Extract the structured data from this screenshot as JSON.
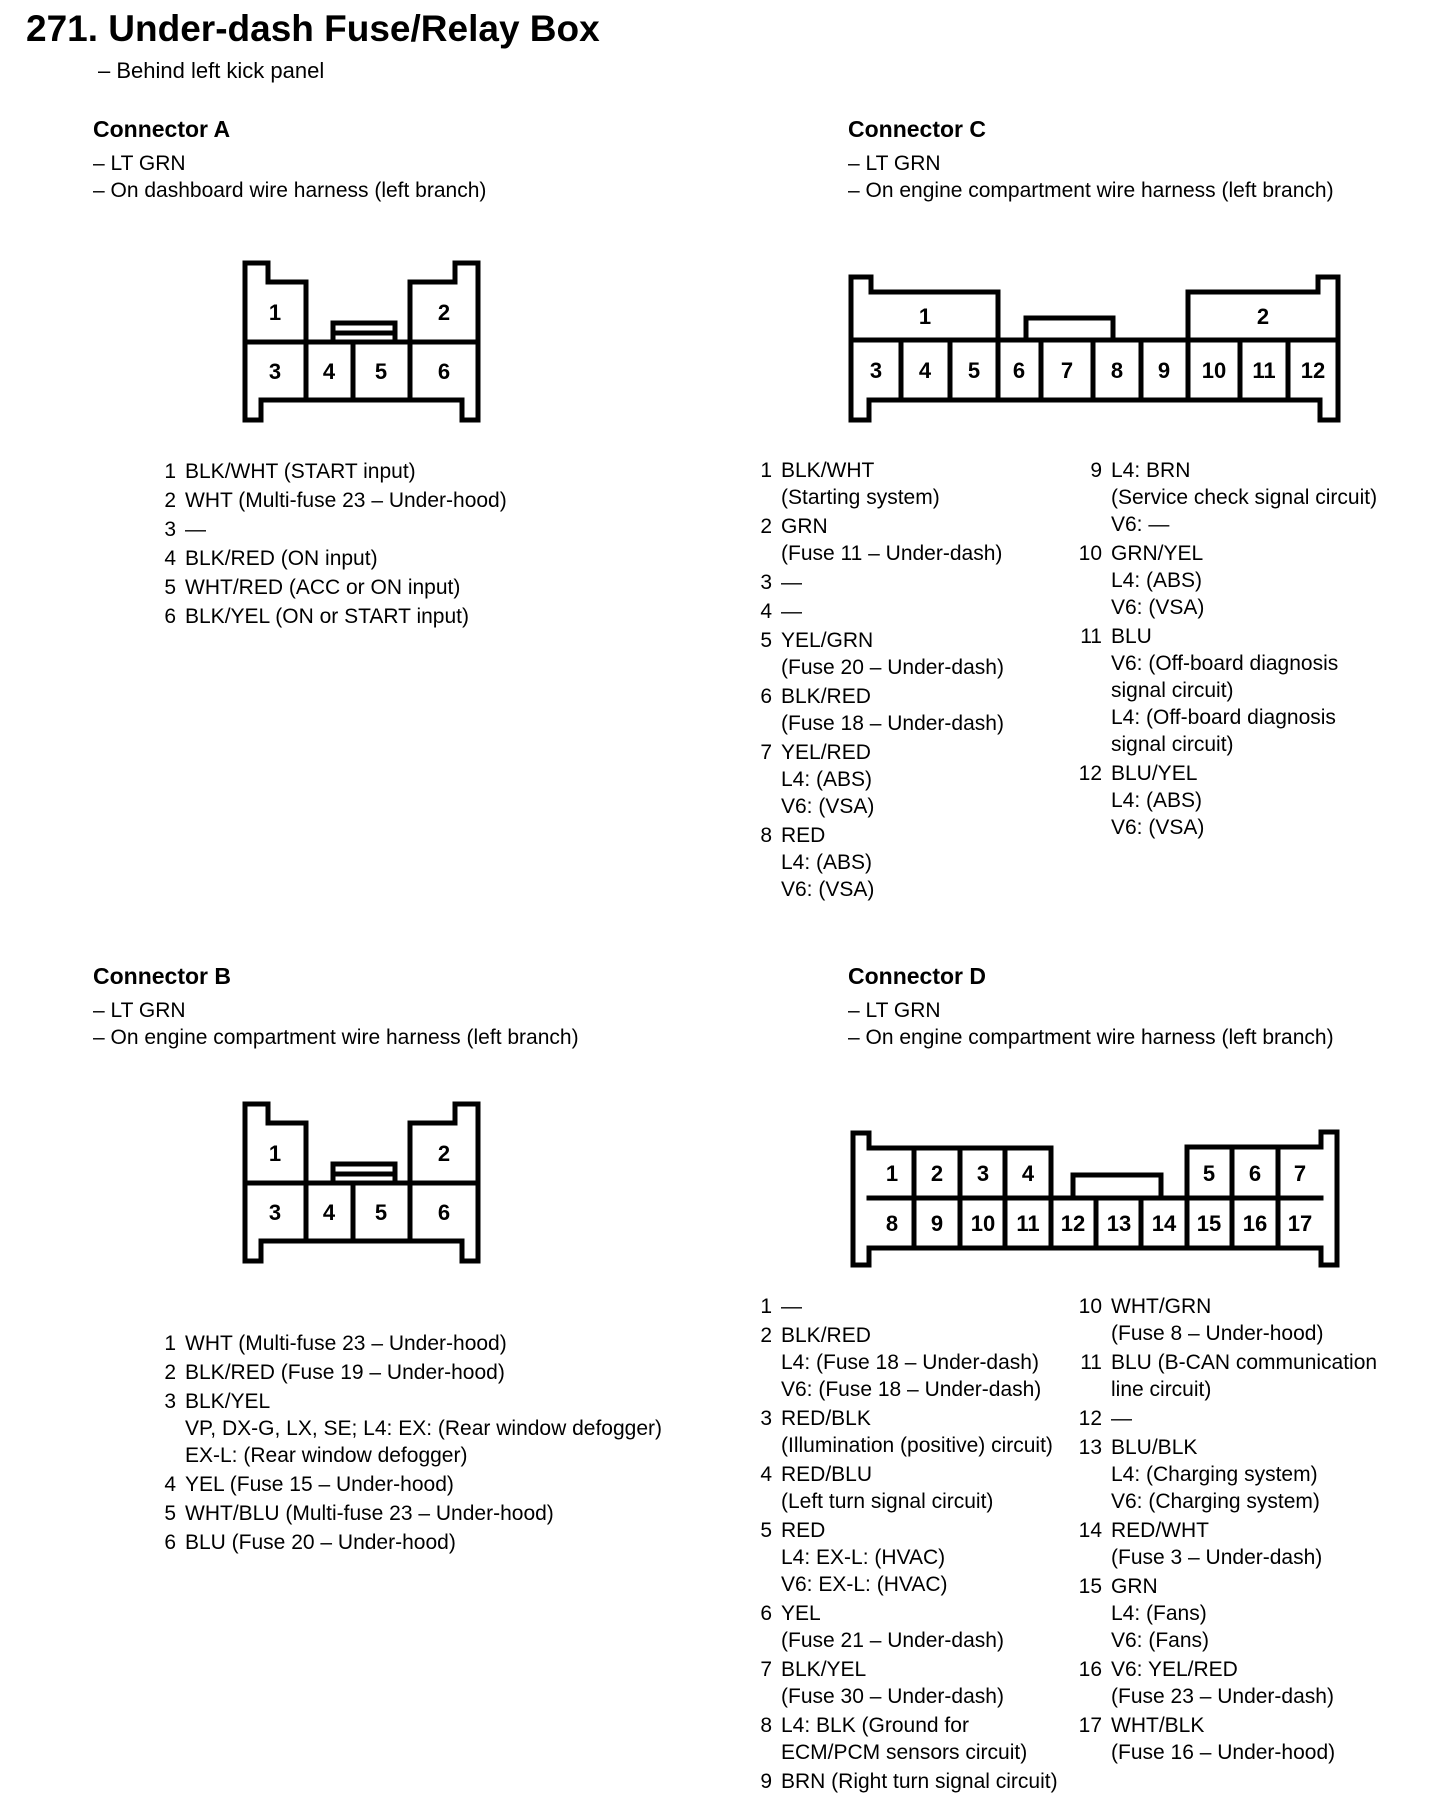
{
  "page": {
    "title": "271. Under-dash Fuse/Relay Box",
    "subnote": "– Behind left kick panel"
  },
  "connectors": [
    {
      "id": "A",
      "heading": "Connector A",
      "notes": [
        "– LT GRN",
        "– On dashboard wire harness (left branch)"
      ],
      "diagram": {
        "top_labels": [
          "1",
          "2"
        ],
        "bottom_labels": [
          "3",
          "4",
          "5",
          "6"
        ]
      },
      "columns": [
        [
          {
            "n": "1",
            "lines": [
              "BLK/WHT (START input)"
            ]
          },
          {
            "n": "2",
            "lines": [
              "WHT (Multi-fuse 23 – Under-hood)"
            ]
          },
          {
            "n": "3",
            "lines": [
              "—"
            ]
          },
          {
            "n": "4",
            "lines": [
              "BLK/RED (ON input)"
            ]
          },
          {
            "n": "5",
            "lines": [
              "WHT/RED (ACC or ON input)"
            ]
          },
          {
            "n": "6",
            "lines": [
              "BLK/YEL (ON or START input)"
            ]
          }
        ]
      ]
    },
    {
      "id": "C",
      "heading": "Connector C",
      "notes": [
        "– LT GRN",
        "– On engine compartment wire harness (left branch)"
      ],
      "diagram": {
        "top_labels": [
          "1",
          "2"
        ],
        "bottom_labels": [
          "3",
          "4",
          "5",
          "6",
          "7",
          "8",
          "9",
          "10",
          "11",
          "12"
        ]
      },
      "columns": [
        [
          {
            "n": "1",
            "lines": [
              "BLK/WHT",
              "(Starting system)"
            ]
          },
          {
            "n": "2",
            "lines": [
              "GRN",
              "(Fuse 11 – Under-dash)"
            ]
          },
          {
            "n": "3",
            "lines": [
              "—"
            ]
          },
          {
            "n": "4",
            "lines": [
              "—"
            ]
          },
          {
            "n": "5",
            "lines": [
              "YEL/GRN",
              "(Fuse 20 – Under-dash)"
            ]
          },
          {
            "n": "6",
            "lines": [
              "BLK/RED",
              "(Fuse 18 – Under-dash)"
            ]
          },
          {
            "n": "7",
            "lines": [
              "YEL/RED",
              "L4: (ABS)",
              "V6: (VSA)"
            ]
          },
          {
            "n": "8",
            "lines": [
              "RED",
              "L4: (ABS)",
              "V6: (VSA)"
            ]
          }
        ],
        [
          {
            "n": "9",
            "lines": [
              "L4: BRN",
              "(Service check signal circuit)",
              "V6: —"
            ]
          },
          {
            "n": "10",
            "lines": [
              "GRN/YEL",
              "L4: (ABS)",
              "V6: (VSA)"
            ]
          },
          {
            "n": "11",
            "lines": [
              "BLU",
              "V6: (Off-board diagnosis",
              "signal circuit)",
              "L4: (Off-board diagnosis",
              "signal circuit)"
            ]
          },
          {
            "n": "12",
            "lines": [
              "BLU/YEL",
              "L4: (ABS)",
              "V6: (VSA)"
            ]
          }
        ]
      ]
    },
    {
      "id": "B",
      "heading": "Connector B",
      "notes": [
        "– LT GRN",
        "– On engine compartment wire harness (left branch)"
      ],
      "diagram": {
        "top_labels": [
          "1",
          "2"
        ],
        "bottom_labels": [
          "3",
          "4",
          "5",
          "6"
        ]
      },
      "columns": [
        [
          {
            "n": "1",
            "lines": [
              "WHT (Multi-fuse 23 – Under-hood)"
            ]
          },
          {
            "n": "2",
            "lines": [
              "BLK/RED (Fuse 19 – Under-hood)"
            ]
          },
          {
            "n": "3",
            "lines": [
              "BLK/YEL",
              "VP, DX-G, LX, SE; L4: EX: (Rear window defogger)",
              "EX-L: (Rear window defogger)"
            ]
          },
          {
            "n": "4",
            "lines": [
              "YEL (Fuse 15 – Under-hood)"
            ]
          },
          {
            "n": "5",
            "lines": [
              "WHT/BLU (Multi-fuse 23 – Under-hood)"
            ]
          },
          {
            "n": "6",
            "lines": [
              "BLU (Fuse 20 – Under-hood)"
            ]
          }
        ]
      ]
    },
    {
      "id": "D",
      "heading": "Connector D",
      "notes": [
        "– LT GRN",
        "– On engine compartment wire harness (left branch)"
      ],
      "diagram": {
        "top_labels": [
          "1",
          "2",
          "3",
          "4",
          "5",
          "6",
          "7"
        ],
        "bottom_labels": [
          "8",
          "9",
          "10",
          "11",
          "12",
          "13",
          "14",
          "15",
          "16",
          "17"
        ]
      },
      "columns": [
        [
          {
            "n": "1",
            "lines": [
              "—"
            ]
          },
          {
            "n": "2",
            "lines": [
              "BLK/RED",
              "L4: (Fuse 18 – Under-dash)",
              "V6: (Fuse 18 – Under-dash)"
            ]
          },
          {
            "n": "3",
            "lines": [
              "RED/BLK",
              "(Illumination (positive) circuit)"
            ]
          },
          {
            "n": "4",
            "lines": [
              "RED/BLU",
              "(Left turn signal circuit)"
            ]
          },
          {
            "n": "5",
            "lines": [
              "RED",
              "L4: EX-L: (HVAC)",
              "V6: EX-L: (HVAC)"
            ]
          },
          {
            "n": "6",
            "lines": [
              "YEL",
              "(Fuse 21 – Under-dash)"
            ]
          },
          {
            "n": "7",
            "lines": [
              "BLK/YEL",
              "(Fuse 30 – Under-dash)"
            ]
          },
          {
            "n": "8",
            "lines": [
              "L4: BLK (Ground for",
              "ECM/PCM sensors circuit)"
            ]
          },
          {
            "n": "9",
            "lines": [
              "BRN (Right turn signal circuit)"
            ]
          }
        ],
        [
          {
            "n": "10",
            "lines": [
              "WHT/GRN",
              "(Fuse 8 – Under-hood)"
            ]
          },
          {
            "n": "11",
            "lines": [
              "BLU (B-CAN communication",
              "line circuit)"
            ]
          },
          {
            "n": "12",
            "lines": [
              "—"
            ]
          },
          {
            "n": "13",
            "lines": [
              "BLU/BLK",
              "L4: (Charging system)",
              "V6: (Charging system)"
            ]
          },
          {
            "n": "14",
            "lines": [
              "RED/WHT",
              "(Fuse 3 – Under-dash)"
            ]
          },
          {
            "n": "15",
            "lines": [
              "GRN",
              "L4: (Fans)",
              "V6: (Fans)"
            ]
          },
          {
            "n": "16",
            "lines": [
              "V6: YEL/RED",
              "(Fuse 23 – Under-dash)"
            ]
          },
          {
            "n": "17",
            "lines": [
              "WHT/BLK",
              "(Fuse 16 – Under-hood)"
            ]
          }
        ]
      ]
    }
  ]
}
